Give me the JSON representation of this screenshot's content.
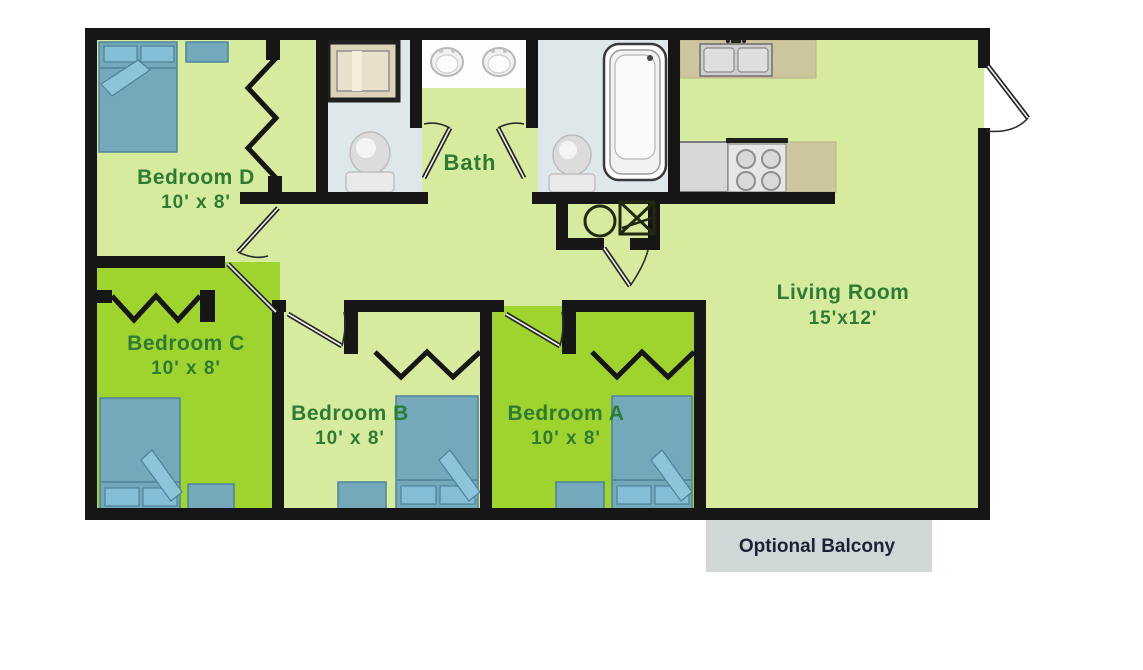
{
  "diagram_type": "apartment-floor-plan",
  "rooms": {
    "bedroom_d": {
      "name": "Bedroom D",
      "dims": "10' x 8'"
    },
    "bedroom_c": {
      "name": "Bedroom C",
      "dims": "10' x 8'"
    },
    "bedroom_b": {
      "name": "Bedroom B",
      "dims": "10' x 8'"
    },
    "bedroom_a": {
      "name": "Bedroom A",
      "dims": "10' x 8'"
    },
    "bath": {
      "name": "Bath"
    },
    "living": {
      "name": "Living Room",
      "dims": "15'x12'"
    },
    "balcony": {
      "name": "Optional Balcony"
    }
  },
  "fixtures": [
    "double-bed x4",
    "nightstand x3",
    "dresser x1",
    "toilet x2",
    "bathtub",
    "shower-stall",
    "vanity-double-sink",
    "kitchen-double-sink",
    "stove-4-burner",
    "refrigerator",
    "washer",
    "dryer",
    "bifold-closet-doors x4",
    "swing-doors x7"
  ],
  "colors": {
    "wall": "#161616",
    "floor_light_green": "#d7eb9e",
    "floor_bright_green": "#9fd32e",
    "bath_floor": "#dee7ea",
    "bed_blue": "#74a9bc",
    "counter_tan": "#cdc69c",
    "shower_tan": "#dcd2b8",
    "balcony_gray": "#d0d7d7",
    "label_green": "#2e7b35",
    "balcony_text": "#1b2436",
    "background": "#ffffff"
  }
}
